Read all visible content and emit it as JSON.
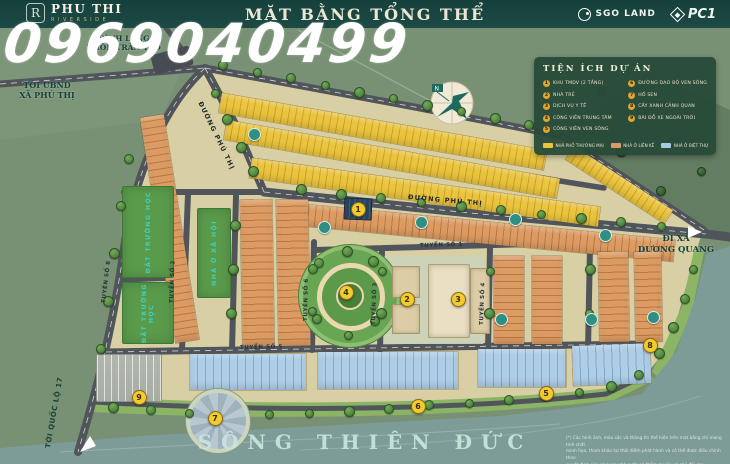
{
  "watermark": "0969040499",
  "header": {
    "title": "MẶT BẰNG TỔNG THỂ",
    "brand": {
      "monogram": "R",
      "name": "PHU THI",
      "tagline": "RIVERSIDE"
    },
    "partners": [
      {
        "name": "SGO LAND"
      },
      {
        "name": "PC1"
      }
    ]
  },
  "legend": {
    "title": "TIỆN ÍCH DỰ ÁN",
    "items": [
      {
        "num": "1",
        "label": "KHU TMDV (2 TẦNG)"
      },
      {
        "num": "2",
        "label": "NHÀ TRẺ"
      },
      {
        "num": "3",
        "label": "DỊCH VỤ Y TẾ"
      },
      {
        "num": "4",
        "label": "CÔNG VIÊN TRUNG TÂM"
      },
      {
        "num": "5",
        "label": "CÔNG VIÊN VEN SÔNG"
      },
      {
        "num": "6",
        "label": "ĐƯỜNG DẠO BỘ VEN SÔNG"
      },
      {
        "num": "7",
        "label": "HỒ SEN"
      },
      {
        "num": "8",
        "label": "CÂY XANH CẢNH QUAN"
      },
      {
        "num": "9",
        "label": "BÃI ĐỖ XE NGOÀI TRỜI"
      }
    ],
    "zones": [
      {
        "color": "#e7c63b",
        "label": "NHÀ PHỐ THƯƠNG MẠI"
      },
      {
        "color": "#d89b69",
        "label": "NHÀ Ở LIỀN KỀ"
      },
      {
        "color": "#a9c9e2",
        "label": "NHÀ Ở BIỆT THỰ"
      }
    ]
  },
  "map": {
    "labels": {
      "dinh_lang": [
        "ĐÌNH LÀNG",
        "THÔN TRÂN TẢO"
      ],
      "toi_ubnd": [
        "TỚI UBND",
        "XÃ PHÚ THỊ"
      ],
      "toi_quoc_lo": "TỚI QUỐC LỘ 17",
      "di_xa": [
        "ĐI XÃ",
        "DƯƠNG QUANG"
      ],
      "river": "SÔNG THIÊN ĐỨC",
      "compass_n": "N"
    },
    "streets": {
      "phu_thi_1": "ĐƯỜNG PHÚ THỊ",
      "phu_thi_2": "ĐƯỜNG PHÚ THỊ",
      "t1": "TUYẾN SỐ 1",
      "t2": "TUYẾN SỐ 2",
      "t3": "TUYẾN SỐ 3",
      "t4": "TUYẾN SỐ 4",
      "t5": "TUYẾN SỐ 5",
      "t6": "TUYẾN SỐ 6",
      "t8": "TUYẾN SỐ 8"
    },
    "zones_text": {
      "school1": "ĐẤT TRƯỜNG HỌC",
      "school2": "ĐẤT TRƯỜNG HỌC",
      "social": "NHÀ Ở XÃ HỘI"
    },
    "markers": [
      {
        "num": "1",
        "x": 357,
        "y": 208
      },
      {
        "num": "2",
        "x": 406,
        "y": 298
      },
      {
        "num": "3",
        "x": 457,
        "y": 298
      },
      {
        "num": "4",
        "x": 345,
        "y": 291
      },
      {
        "num": "5",
        "x": 545,
        "y": 392
      },
      {
        "num": "6",
        "x": 417,
        "y": 405
      },
      {
        "num": "7",
        "x": 214,
        "y": 417
      },
      {
        "num": "8",
        "x": 649,
        "y": 344
      },
      {
        "num": "9",
        "x": 138,
        "y": 396
      }
    ],
    "disclaimer": [
      "(*) Các hình ảnh, màu sắc và thông tin thể hiện trên mặt bằng chỉ mang tính chất",
      "minh họa, tham khảo tại thời điểm phát hành và có thể được điều chỉnh theo",
      "quyết định của cơ quan nhà nước có thẩm quyền và chủ đầu tư."
    ]
  }
}
